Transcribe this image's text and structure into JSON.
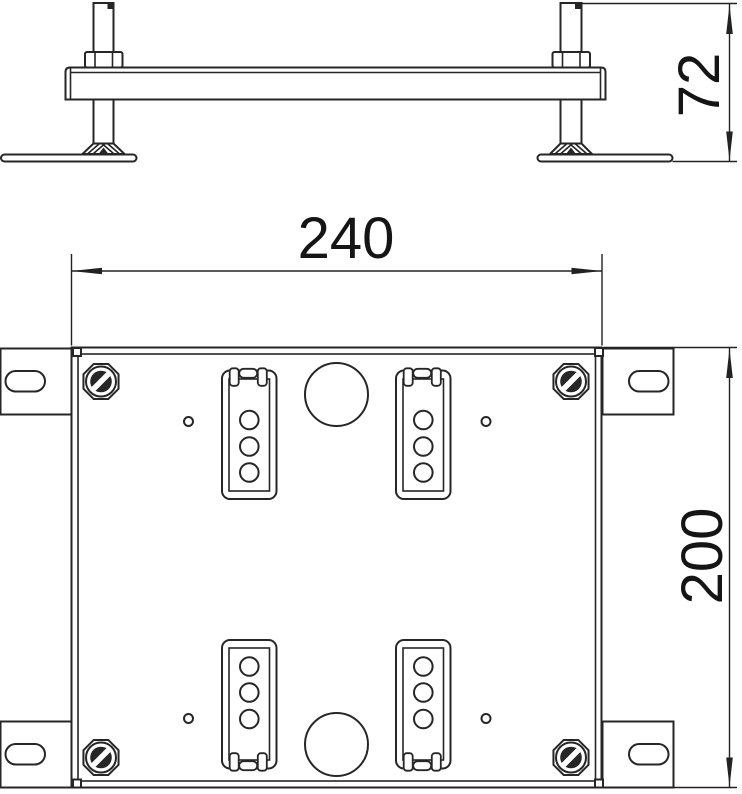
{
  "meta": {
    "type": "technical-drawing",
    "views": [
      "side-elevation",
      "top-plan"
    ]
  },
  "colors": {
    "background": "#ffffff",
    "line": "#262626",
    "dimension_text": "#151515"
  },
  "dimensions": {
    "side_height": {
      "label": "72"
    },
    "plan_width": {
      "label": "240"
    },
    "plan_height": {
      "label": "200"
    }
  }
}
